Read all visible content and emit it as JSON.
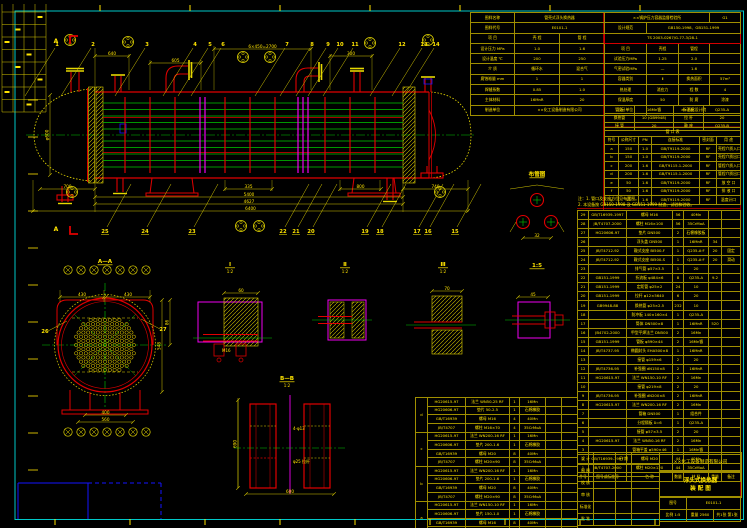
{
  "sheet": {
    "type_label": "浮头式换热器装配图",
    "standards": "GB150-1998、GB151-1999",
    "stamp": "TS 2003-0267/G-77-3/28-1"
  },
  "design_left": {
    "rows": [
      [
        "图样名称",
        {
          "t": "管壳式浮头换热器",
          "s": 2
        }
      ],
      [
        "图样代号",
        {
          "t": "E0101-1",
          "s": 2
        }
      ],
      [
        "项 目",
        "壳 程",
        "管 程"
      ],
      [
        "设计压力 MPa",
        "1.0",
        "1.6"
      ],
      [
        "设计温度 ℃",
        "200",
        "250"
      ],
      [
        "介 质",
        "循环水",
        "混合气"
      ],
      [
        "腐蚀裕量 mm",
        "1",
        "1"
      ],
      [
        "焊缝系数",
        "0.85",
        "1.0"
      ],
      [
        "主体材料",
        "16MnR",
        "20"
      ],
      [
        "制造单位",
        {
          "t": "××化工设备制造有限公司",
          "s": 2
        }
      ]
    ]
  },
  "design_right": {
    "rows": [
      [
        {
          "t": "××锅炉压力容器监督检验所",
          "s": 3
        },
        "G1"
      ],
      [
        "设计规范",
        {
          "t": "GB150-1998、GB151-1999",
          "s": 3
        }
      ],
      [
        {
          "t": "TS 2003-0267/G-77-3/28-1",
          "s": 4
        }
      ],
      [
        "项 目",
        "壳程",
        "管程",
        ""
      ],
      [
        "试验压力MPa",
        "1.25",
        "2.0",
        ""
      ],
      [
        "气密试验MPa",
        "—",
        "1.6",
        ""
      ],
      [
        "容器类别",
        "Ⅱ",
        "换热面积",
        "57m²"
      ],
      [
        "热处理",
        "消应力",
        "程 数",
        "4"
      ],
      [
        "保温厚度",
        "50",
        "防 腐",
        "涂漆"
      ],
      [
        "设计单位",
        {
          "t": "××石化设计院",
          "s": 3
        }
      ]
    ],
    "stamp_row": 2
  },
  "material_table": {
    "rows": [
      [
        "管 板",
        "16Mn锻",
        "折流板",
        "Q235-A"
      ],
      [
        "换热管",
        "10 (GB9948)",
        "拉 杆",
        "20"
      ],
      [
        "接 管",
        "20",
        "鞍 座",
        "Q235-B"
      ]
    ]
  },
  "nozzle_table": {
    "title": "管  口  表",
    "header": [
      "符号",
      "公称尺寸",
      "PN",
      "连接标准",
      "密封面",
      "用 途"
    ],
    "rows": [
      [
        "a",
        "150",
        "1.0",
        "GB/T9119-2000",
        "RF",
        "壳程介质入口"
      ],
      [
        "b",
        "150",
        "1.0",
        "GB/T9119-2000",
        "RF",
        "壳程介质出口"
      ],
      [
        "c",
        "200",
        "1.6",
        "GB/T9115.1-2000",
        "RF",
        "管程介质入口"
      ],
      [
        "d",
        "200",
        "1.6",
        "GB/T9115.1-2000",
        "RF",
        "管程介质出口"
      ],
      [
        "e",
        "50",
        "1.6",
        "GB/T9119-2000",
        "RF",
        "放 空 口"
      ],
      [
        "f",
        "50",
        "1.6",
        "GB/T9119-2000",
        "RF",
        "排 液 口"
      ],
      [
        "g",
        "25",
        "1.6",
        "GB/T9119-2000",
        "RF",
        "温度计口"
      ]
    ]
  },
  "notes": {
    "lines": [
      "注：1. 管口及支座方位见布置图。",
      "2. 本设备按 GB150-1998 及 GB151-1999 制造、试验和验收。"
    ]
  },
  "bom": {
    "header": [
      "件号",
      "图号或标准号",
      "名  称",
      "数量",
      "材 料",
      "重量",
      "备注"
    ],
    "rows": [
      [
        "29",
        "GB/T16939-1997",
        "螺母 M16",
        "56",
        "40Mn",
        "",
        ""
      ],
      [
        "28",
        "JB/T4707-2000",
        "螺柱 M16×100",
        "56",
        "35CrMoA",
        "",
        ""
      ],
      [
        "27",
        "HG20606-97",
        "垫片 DN500",
        "2",
        "石棉橡胶板",
        "",
        ""
      ],
      [
        "26",
        "",
        "浮头盖 DN500",
        "1",
        "16MnR",
        "34",
        ""
      ],
      [
        "25",
        "JB/T4712-92",
        "鞍式支座 BⅠ500-F",
        "1",
        "Q235-A·F",
        "20",
        "固定"
      ],
      [
        "24",
        "JB/T4712-92",
        "鞍式支座 BⅠ500-S",
        "1",
        "Q235-A·F",
        "20",
        "滑动"
      ],
      [
        "23",
        "",
        "排气管 φ57×3.5",
        "1",
        "20",
        "",
        ""
      ],
      [
        "22",
        "GB151-1999",
        "折流板 φ484×6",
        "8",
        "Q235-A",
        "9.2",
        ""
      ],
      [
        "21",
        "GB151-1999",
        "定距管 φ25×2",
        "24",
        "10",
        "",
        ""
      ],
      [
        "20",
        "GB151-1999",
        "拉杆 φ12×5640",
        "6",
        "20",
        "",
        ""
      ],
      [
        "19",
        "GB9948-88",
        "换热管 φ25×2.5",
        "232",
        "10",
        "",
        ""
      ],
      [
        "18",
        "",
        "防冲板 140×160×4",
        "1",
        "Q235-A",
        "",
        ""
      ],
      [
        "17",
        "",
        "筒体 DN500×8",
        "1",
        "16MnR",
        "520",
        ""
      ],
      [
        "16",
        "JB4702-2000",
        "甲型平焊法兰 DN500",
        "2",
        "16Mn",
        "",
        ""
      ],
      [
        "15",
        "GB151-1999",
        "管板 φ590×44",
        "2",
        "16Mn锻",
        "",
        ""
      ],
      [
        "14",
        "JB/T4737-95",
        "椭圆封头 EHA500×8",
        "1",
        "16MnR",
        "",
        ""
      ],
      [
        "13",
        "",
        "接管 φ159×6",
        "2",
        "20",
        "",
        ""
      ],
      [
        "12",
        "JB/T4736-95",
        "补强圈 dN150×8",
        "2",
        "16MnR",
        "",
        ""
      ],
      [
        "11",
        "HG20615-97",
        "法兰 WN150-10 RF",
        "2",
        "16Mn",
        "",
        ""
      ],
      [
        "10",
        "",
        "接管 φ219×8",
        "2",
        "20",
        "",
        ""
      ],
      [
        "9",
        "JB/T4736-95",
        "补强圈 dN200×8",
        "2",
        "16MnR",
        "",
        ""
      ],
      [
        "8",
        "HG20615-97",
        "法兰 WN200-16 RF",
        "2",
        "16Mn",
        "",
        ""
      ],
      [
        "7",
        "",
        "管箱 DN500",
        "1",
        "组合件",
        "",
        ""
      ],
      [
        "6",
        "",
        "分程隔板 δ=6",
        "1",
        "Q235-A",
        "",
        ""
      ],
      [
        "5",
        "",
        "接管 φ57×3.5",
        "2",
        "20",
        "",
        ""
      ],
      [
        "4",
        "HG20615-97",
        "法兰 WN50-16 RF",
        "2",
        "16Mn",
        "",
        ""
      ],
      [
        "3",
        "",
        "管箱平盖 φ590×46",
        "1",
        "16Mn锻",
        "",
        ""
      ],
      [
        "2",
        "GB/T16939-1997",
        "螺母 M20",
        "44",
        "40Mn",
        "",
        ""
      ],
      [
        "1",
        "JB/T4707-2000",
        "螺柱 M20×120",
        "44",
        "35CrMoA",
        "",
        ""
      ]
    ]
  },
  "title_block": {
    "sig_rows": [
      [
        "设 计",
        "",
        "日 期",
        ""
      ],
      [
        "制 图",
        "",
        "",
        ""
      ],
      [
        "校 核",
        "",
        "",
        ""
      ],
      [
        "审 核",
        "",
        "",
        ""
      ],
      [
        "标准化",
        "",
        "",
        ""
      ],
      [
        "批 准",
        "",
        "",
        ""
      ]
    ],
    "company": "××化工设备制造有限公司",
    "title_line1": "浮头式换热器",
    "title_line2": "装 配 图",
    "info_rows": [
      [
        {
          "t": "图号",
          "s": 1
        },
        {
          "t": "E0101-1",
          "s": 2
        }
      ],
      [
        "比例 1:5",
        "重量 2560",
        "共1张 第1张"
      ]
    ]
  },
  "flange_parts": {
    "groups": [
      {
        "label": "d",
        "rows": [
          [
            "HG20615-97",
            "法兰 WN50-25 RF",
            "1",
            "16Mn",
            "",
            ""
          ],
          [
            "HG20606-97",
            "垫片 50-2.5",
            "1",
            "石棉橡胶",
            "",
            ""
          ],
          [
            "GB/T16939",
            "螺母 M16",
            "4",
            "40Mn",
            "",
            ""
          ],
          [
            "JB/T4707",
            "螺柱 M16×70",
            "4",
            "35CrMoA",
            "",
            ""
          ]
        ]
      },
      {
        "label": "c",
        "rows": [
          [
            "HG20615-97",
            "法兰 WN200-16 RF",
            "1",
            "16Mn",
            "",
            ""
          ],
          [
            "HG20606-97",
            "垫片 200-1.6",
            "1",
            "石棉橡胶",
            "",
            ""
          ],
          [
            "GB/T16939",
            "螺母 M20",
            "8",
            "40Mn",
            "",
            ""
          ],
          [
            "JB/T4707",
            "螺柱 M20×90",
            "8",
            "35CrMoA",
            "",
            ""
          ]
        ]
      },
      {
        "label": "b",
        "rows": [
          [
            "HG20615-97",
            "法兰 WN200-16 RF",
            "1",
            "16Mn",
            "",
            ""
          ],
          [
            "HG20606-97",
            "垫片 200-1.6",
            "1",
            "石棉橡胶",
            "",
            ""
          ],
          [
            "GB/T16939",
            "螺母 M20",
            "8",
            "40Mn",
            "",
            ""
          ],
          [
            "JB/T4707",
            "螺柱 M20×90",
            "8",
            "35CrMoA",
            "",
            ""
          ]
        ]
      },
      {
        "label": "a",
        "rows": [
          [
            "HG20615-97",
            "法兰 WN150-10 RF",
            "1",
            "16Mn",
            "",
            ""
          ],
          [
            "HG20606-97",
            "垫片 150-1.0",
            "1",
            "石棉橡胶",
            "",
            ""
          ],
          [
            "GB/T16939",
            "螺母 M16",
            "8",
            "40Mn",
            "",
            ""
          ],
          [
            "JB/T4707",
            "螺柱 M16×80",
            "8",
            "35CrMoA",
            "",
            ""
          ]
        ]
      }
    ]
  },
  "callouts": {
    "top": [
      [
        1,
        57
      ],
      [
        2,
        93
      ],
      [
        3,
        147
      ],
      [
        4,
        195
      ],
      [
        5,
        210
      ],
      [
        6,
        223
      ],
      [
        7,
        287
      ],
      [
        8,
        312
      ],
      [
        9,
        328
      ],
      [
        10,
        340
      ],
      [
        11,
        355
      ],
      [
        12,
        402
      ],
      [
        13,
        424
      ],
      [
        14,
        436
      ]
    ],
    "bottom": [
      [
        25,
        105
      ],
      [
        24,
        145
      ],
      [
        23,
        192
      ],
      [
        22,
        283
      ],
      [
        21,
        296
      ],
      [
        20,
        311
      ],
      [
        19,
        365
      ],
      [
        18,
        380
      ],
      [
        17,
        417
      ],
      [
        16,
        428
      ],
      [
        15,
        455
      ]
    ],
    "other": [
      [
        26,
        45,
        333,
        1
      ],
      [
        27,
        163,
        331,
        -1
      ]
    ]
  },
  "dimensions": {
    "horizontal": [
      [
        "700",
        40,
        95,
        189
      ],
      [
        "335",
        225,
        272,
        189
      ],
      [
        "800",
        340,
        381,
        189
      ],
      [
        "740",
        403,
        468,
        189
      ],
      [
        "5400",
        95,
        403,
        197
      ],
      [
        "4627",
        95,
        403,
        204
      ],
      [
        "6400",
        33,
        468,
        211
      ],
      [
        "640",
        95,
        129,
        56
      ],
      [
        "605",
        150,
        201,
        63
      ],
      [
        "6×450=2700",
        214,
        311,
        49
      ],
      [
        "300",
        330,
        372,
        56
      ],
      [
        "430",
        60,
        104,
        297
      ],
      [
        "430",
        106,
        150,
        297
      ],
      [
        "400",
        85,
        126,
        415
      ],
      [
        "560",
        78,
        133,
        422
      ],
      [
        "600",
        246,
        334,
        494
      ],
      [
        "60",
        224,
        258,
        293
      ],
      [
        "70",
        432,
        462,
        291
      ],
      [
        "45",
        518,
        548,
        297
      ],
      [
        "32",
        523,
        551,
        238
      ]
    ],
    "vertical": [
      [
        "φ600",
        50,
        95,
        175
      ],
      [
        "548",
        162,
        300,
        392
      ],
      [
        "86",
        170,
        300,
        345
      ],
      [
        "690",
        238,
        400,
        488
      ]
    ]
  },
  "view_labels": [
    {
      "t": "A—A",
      "x": 105,
      "y": 263,
      "sub": ""
    },
    {
      "t": "Ⅰ",
      "x": 230,
      "y": 266,
      "sub": "1:2"
    },
    {
      "t": "Ⅱ",
      "x": 345,
      "y": 266,
      "sub": "1:2"
    },
    {
      "t": "Ⅲ",
      "x": 443,
      "y": 266,
      "sub": "1:2"
    },
    {
      "t": "B—B",
      "x": 287,
      "y": 380,
      "sub": "1:2"
    },
    {
      "t": "布管图",
      "x": 537,
      "y": 176,
      "sub": ""
    },
    {
      "t": "1:5",
      "x": 537,
      "y": 267,
      "sub": ""
    }
  ],
  "detail_texts": [
    [
      "4-φ13",
      293,
      430
    ],
    [
      "φ25 拉杆",
      293,
      463
    ],
    [
      "M16",
      222,
      352
    ]
  ],
  "section_marks": [
    {
      "t": "A",
      "x": 62,
      "y": 41
    },
    {
      "t": "A",
      "x": 62,
      "y": 229
    }
  ],
  "colors": {
    "frame": "#00c8c8",
    "line_yellow": "#d6c800",
    "text_yellow": "#ffe400",
    "red": "#e00000",
    "green": "#00c800",
    "magenta": "#f000f0",
    "blue": "#1414ff"
  }
}
